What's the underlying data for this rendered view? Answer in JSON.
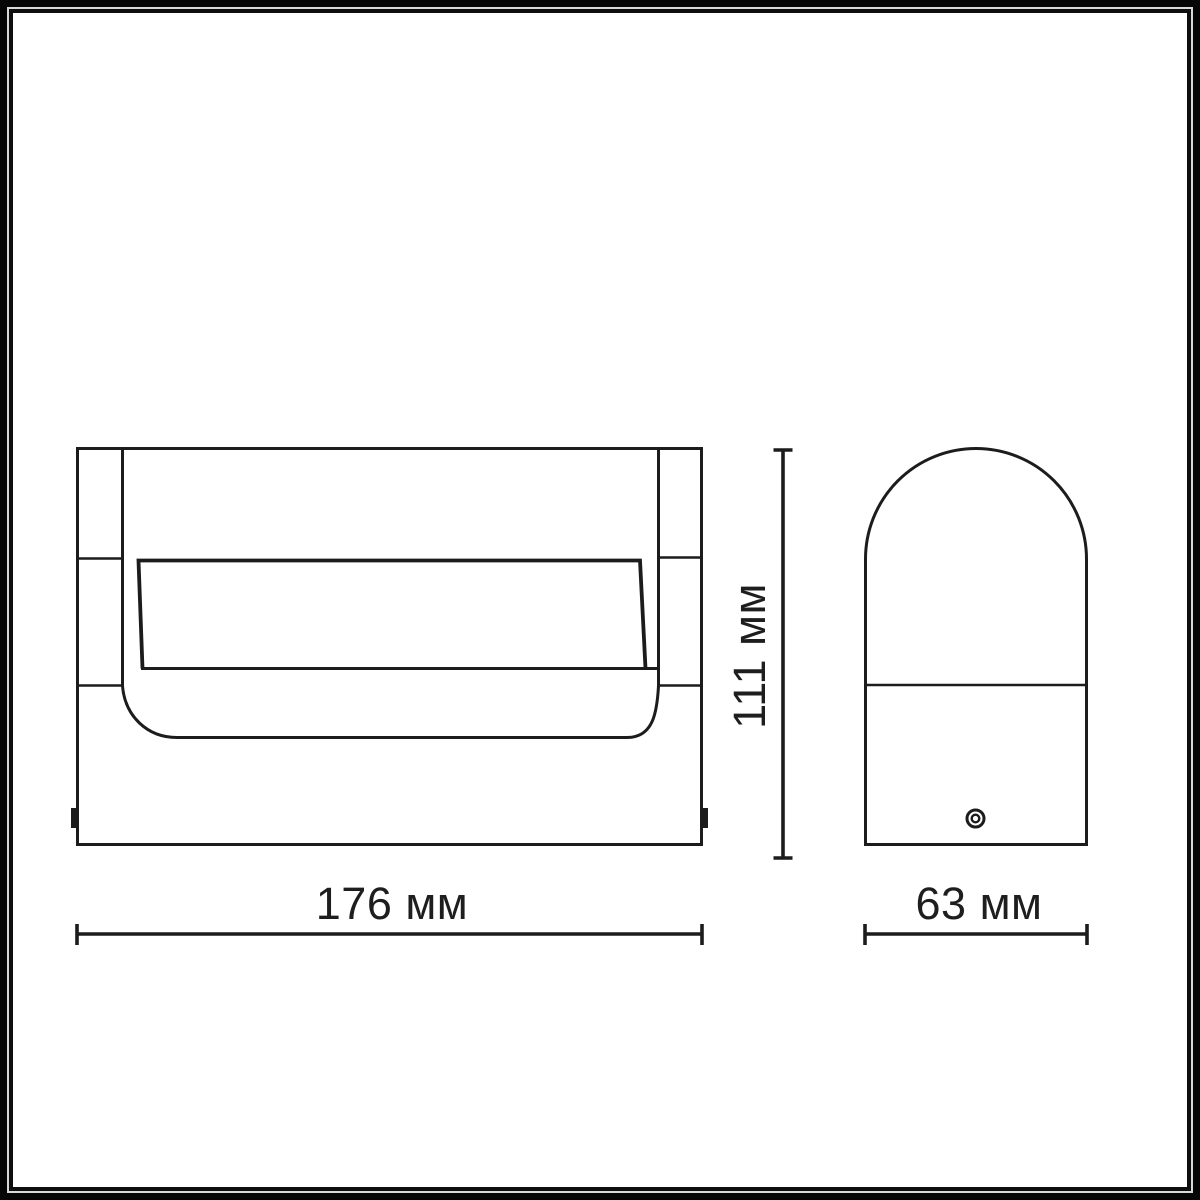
{
  "drawing": {
    "kind": "product dimensional drawing",
    "views": {
      "front": "front-view",
      "side": "side-view"
    }
  },
  "dimensions": {
    "width": {
      "label": "176 мм",
      "value_mm": 176
    },
    "height": {
      "label": "111 мм",
      "value_mm": 111
    },
    "depth": {
      "label": "63 мм",
      "value_mm": 63
    }
  },
  "colors": {
    "background": "#ffffff",
    "line": "#1c1c1c",
    "text": "#1e1e1e",
    "frame_outer": "#060606",
    "frame_gap": "#d9d9d9",
    "frame_inner": "#0e0e0e"
  }
}
